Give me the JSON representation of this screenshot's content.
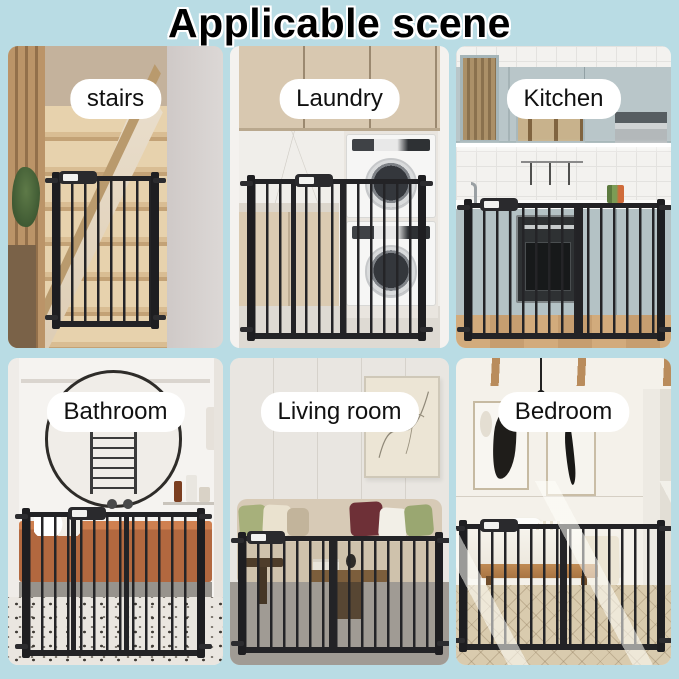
{
  "title": "Applicable scene",
  "panels": [
    {
      "id": "stairs",
      "label": "stairs"
    },
    {
      "id": "laundry",
      "label": "Laundry"
    },
    {
      "id": "kitchen",
      "label": "Kitchen"
    },
    {
      "id": "bathroom",
      "label": "Bathroom"
    },
    {
      "id": "living-room",
      "label": "Living room"
    },
    {
      "id": "bedroom",
      "label": "Bedroom"
    }
  ],
  "colors": {
    "background": "#b9dce4",
    "gate": "#232326",
    "label_background": "#ffffff",
    "label_text": "#111111",
    "title_text": "#000000",
    "title_outline": "#ffffff"
  }
}
